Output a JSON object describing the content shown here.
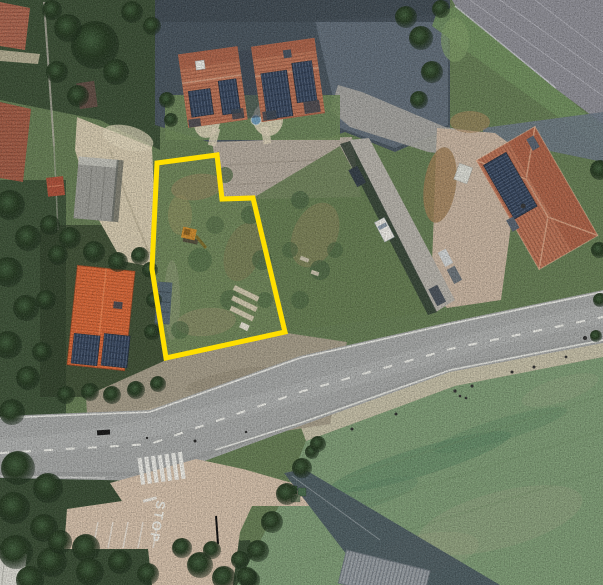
{
  "scene": {
    "type": "aerial-satellite-photo",
    "subject": "vacant land parcel outlined in yellow beside a road junction with houses and a field"
  },
  "parcel": {
    "outline_points": "157,163 217,155 222,199 253,198 285,332 166,358 152,269",
    "outline_color": "#ffdf00",
    "outline_width": "5"
  },
  "road_markings": {
    "stop_text": "STOP"
  },
  "palette": {
    "base-veg": "#647c52",
    "veg-dark": "#31452e",
    "tree-dark": "#1e3020",
    "tree-mid": "#3c5737",
    "asphalt-dark": "#46525c",
    "asphalt-mid": "#6b7884",
    "warehouse-roof": "#8e8e96",
    "terracotta": "#bf7557",
    "terracotta-dark": "#a4563c",
    "ridge-light": "#dca88a",
    "orange-roof": "#de6a3a",
    "solar-panel": "#2f3e55",
    "gravel": "#d5c9ae",
    "concrete-apron": "#b3a99c",
    "lane": "#b5b1a9",
    "driveway-pink": "#c8b4a0",
    "dirt": "#9d7c53",
    "road": "#a5a7a6",
    "road-light": "#b8baba",
    "marking-white": "#f0f0ea",
    "shoulder": "#c9c2ab",
    "field": "#7d9b74",
    "field-dark": "#55815f",
    "field-light": "#a2a687",
    "scrub": "#6d8457",
    "scrub-brown": "#8f835c",
    "pavement-pink": "#d4bfa9"
  }
}
